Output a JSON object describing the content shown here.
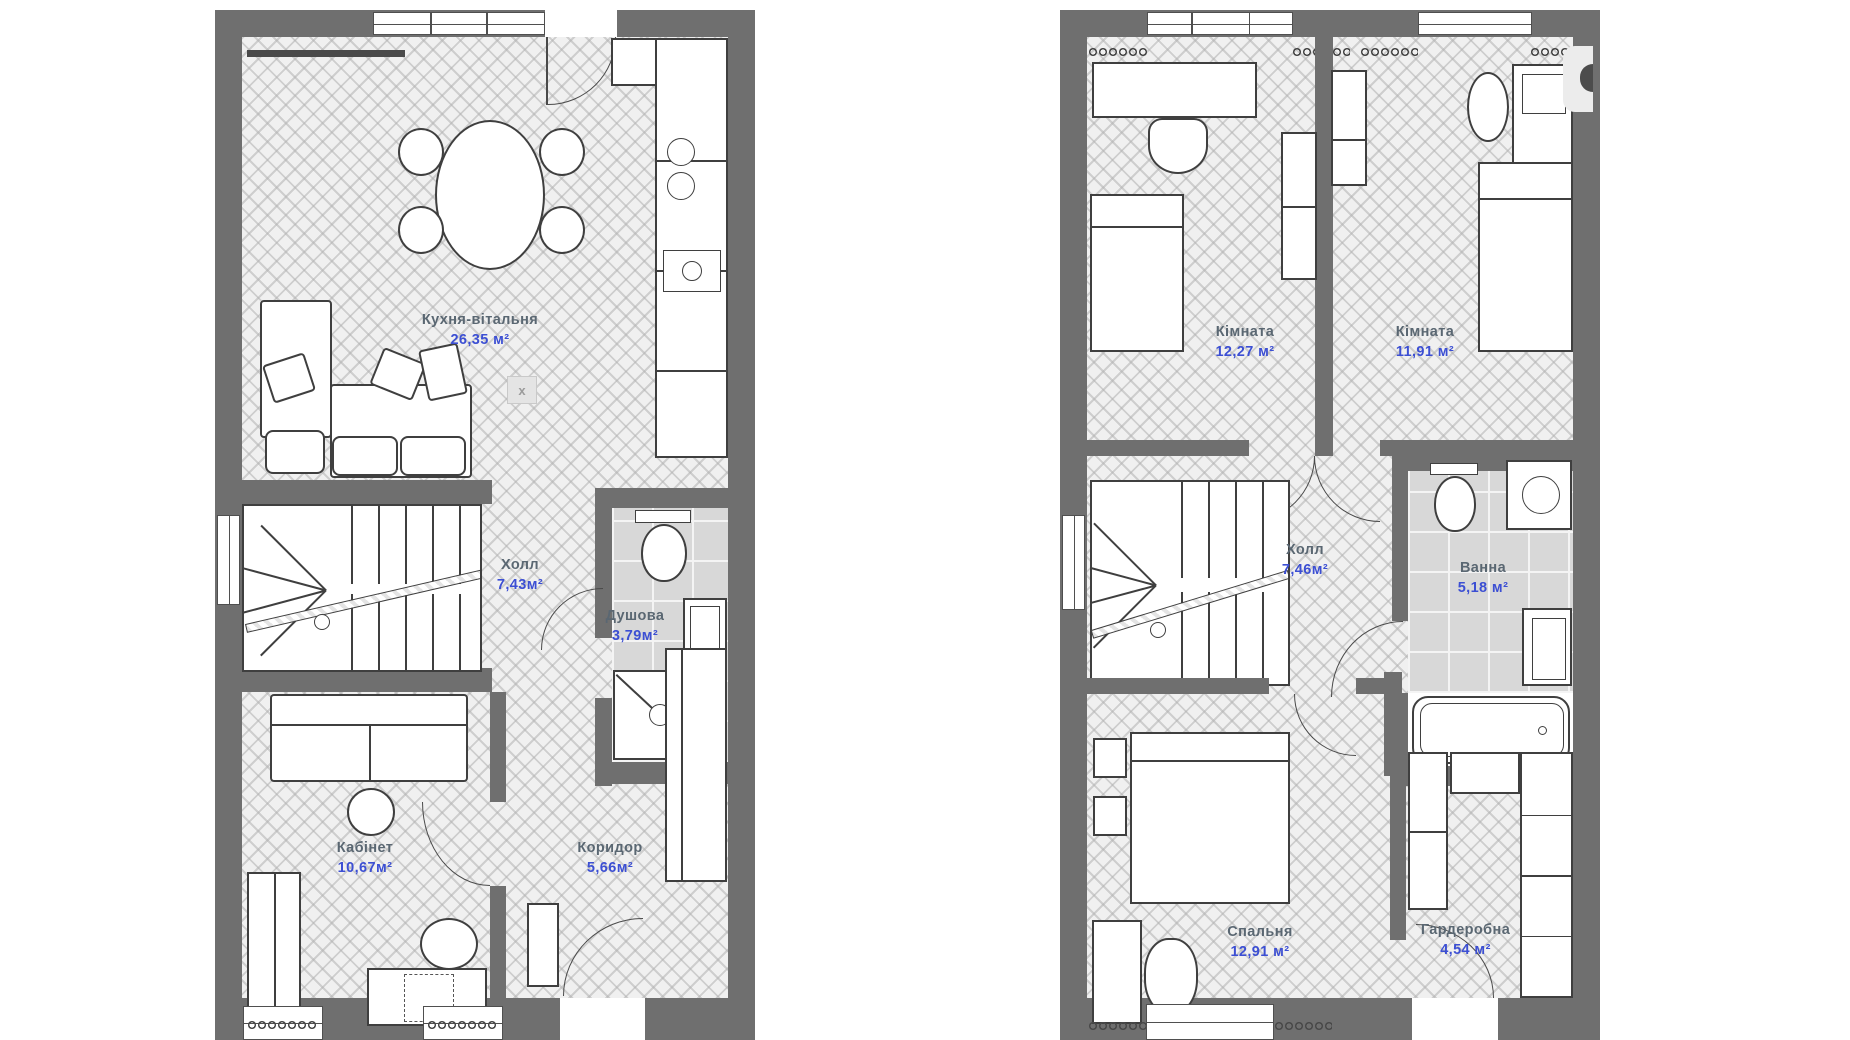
{
  "colors": {
    "wall": "#6f6f6f",
    "floor_base": "#f0f0f0",
    "floor_line": "#b2b2b2",
    "tile_base": "#d8d8d8",
    "outline": "#3f3f3f",
    "room_name": "#5a6772",
    "room_area": "#3c4fd3",
    "background": "#ffffff"
  },
  "plans": [
    {
      "id": "floor-1",
      "marker": "x",
      "rooms": [
        {
          "name": "Кухня-вітальня",
          "area": "26,35 м²"
        },
        {
          "name": "Холл",
          "area": "7,43м²"
        },
        {
          "name": "Душова",
          "area": "3,79м²"
        },
        {
          "name": "Кабінет",
          "area": "10,67м²"
        },
        {
          "name": "Коридор",
          "area": "5,66м²"
        }
      ]
    },
    {
      "id": "floor-2",
      "rooms": [
        {
          "name": "Кімната",
          "area": "12,27 м²"
        },
        {
          "name": "Кімната",
          "area": "11,91 м²"
        },
        {
          "name": "Холл",
          "area": "7,46м²"
        },
        {
          "name": "Ванна",
          "area": "5,18 м²"
        },
        {
          "name": "Спальня",
          "area": "12,91 м²"
        },
        {
          "name": "Гардеробна",
          "area": "4,54 м²"
        }
      ]
    }
  ],
  "controls": {
    "next_button": {
      "icon": "half-circle"
    }
  }
}
